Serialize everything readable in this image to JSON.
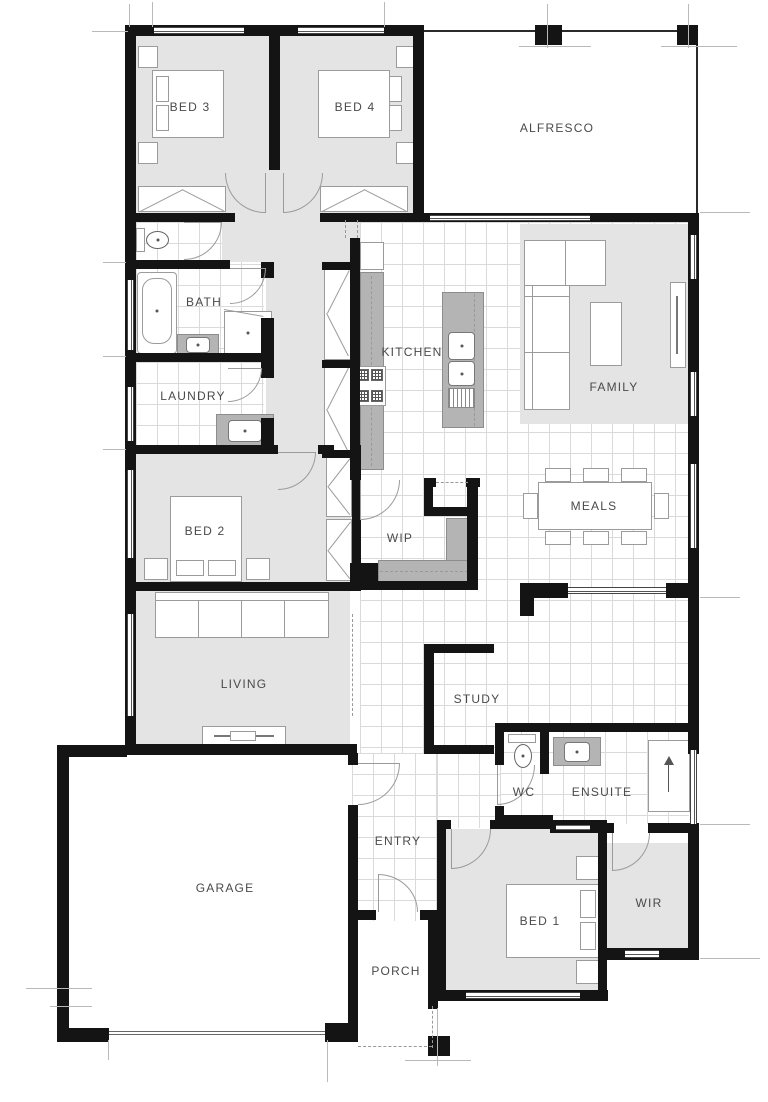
{
  "drawing": {
    "type": "residential single-storey floor plan",
    "colors": {
      "wall": "#141414",
      "carpet": "#e4e4e4",
      "tile_line": "#dadada",
      "bench": "#b4b4b4",
      "fixture_line": "#9b9b9b",
      "label_text": "#4a4a4a"
    }
  },
  "rooms": {
    "bed3": {
      "label": "BED 3"
    },
    "bed4": {
      "label": "BED 4"
    },
    "alfresco": {
      "label": "ALFRESCO"
    },
    "bath": {
      "label": "BATH"
    },
    "laundry": {
      "label": "LAUNDRY"
    },
    "kitchen": {
      "label": "KITCHEN"
    },
    "family": {
      "label": "FAMILY"
    },
    "meals": {
      "label": "MEALS"
    },
    "bed2": {
      "label": "BED 2"
    },
    "wip": {
      "label": "WIP"
    },
    "living": {
      "label": "LIVING"
    },
    "study": {
      "label": "STUDY"
    },
    "wc": {
      "label": "WC"
    },
    "ensuite": {
      "label": "ENSUITE"
    },
    "entry": {
      "label": "ENTRY"
    },
    "garage": {
      "label": "GARAGE"
    },
    "bed1": {
      "label": "BED 1"
    },
    "wir": {
      "label": "WIR"
    },
    "porch": {
      "label": "PORCH"
    }
  }
}
